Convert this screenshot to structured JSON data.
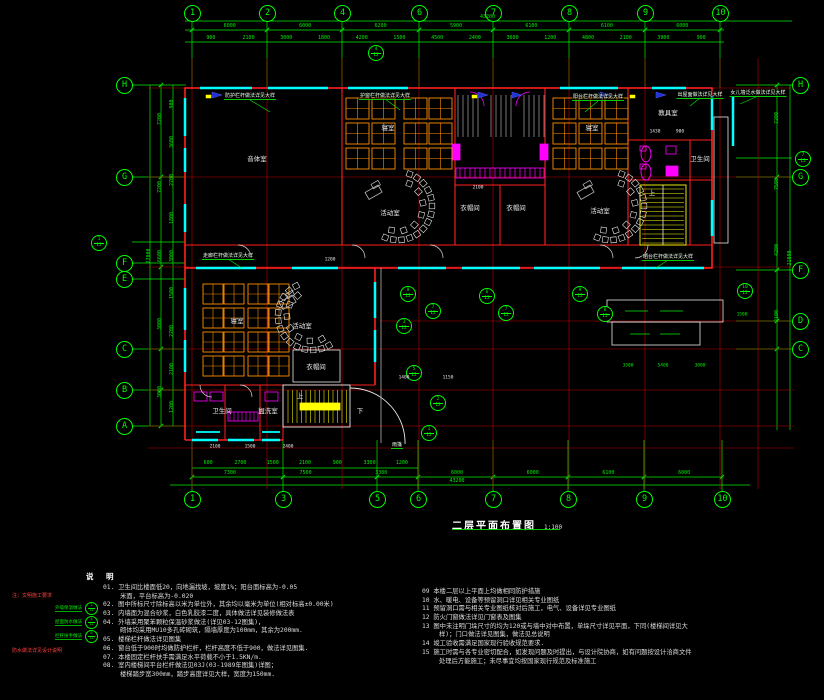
{
  "drawing": {
    "title": "二层平面布置图",
    "scale": "1:100",
    "colors": {
      "background": "#000000",
      "grid_green": "#00ee00",
      "wall_red": "#ff2020",
      "window_cyan": "#00ffff",
      "fixture_magenta": "#ff00ff",
      "stair_yellow": "#ffff00",
      "furniture_orange": "#ff8d00",
      "text_white": "#e8e8e8",
      "note_red": "#ff4040"
    },
    "grid": {
      "top": [
        {
          "label": "1",
          "x": 192
        },
        {
          "label": "2",
          "x": 267
        },
        {
          "label": "4",
          "x": 342
        },
        {
          "label": "6",
          "x": 419
        },
        {
          "label": "7",
          "x": 493
        },
        {
          "label": "8",
          "x": 569
        },
        {
          "label": "9",
          "x": 645
        },
        {
          "label": "10",
          "x": 720
        }
      ],
      "bottom": [
        {
          "label": "1",
          "x": 192
        },
        {
          "label": "3",
          "x": 283
        },
        {
          "label": "5",
          "x": 377
        },
        {
          "label": "6",
          "x": 418
        },
        {
          "label": "7",
          "x": 493
        },
        {
          "label": "8",
          "x": 568
        },
        {
          "label": "9",
          "x": 644
        },
        {
          "label": "10",
          "x": 722
        }
      ],
      "left": [
        {
          "label": "H",
          "y": 85
        },
        {
          "label": "G",
          "y": 177
        },
        {
          "label": "F",
          "y": 263
        },
        {
          "label": "E",
          "y": 279
        },
        {
          "label": "C",
          "y": 349
        },
        {
          "label": "B",
          "y": 390
        },
        {
          "label": "A",
          "y": 426
        }
      ],
      "right": [
        {
          "label": "H",
          "y": 85
        },
        {
          "label": "G",
          "y": 177
        },
        {
          "label": "F",
          "y": 270
        },
        {
          "label": "D",
          "y": 321
        },
        {
          "label": "C",
          "y": 349
        }
      ]
    },
    "rooms": [
      {
        "name": "音体室",
        "x": 257,
        "y": 158
      },
      {
        "name": "寝室",
        "x": 388,
        "y": 127
      },
      {
        "name": "寝室",
        "x": 592,
        "y": 127
      },
      {
        "name": "教具室",
        "x": 668,
        "y": 112
      },
      {
        "name": "卫生间",
        "x": 700,
        "y": 158
      },
      {
        "name": "活动室",
        "x": 390,
        "y": 212
      },
      {
        "name": "活动室",
        "x": 600,
        "y": 210
      },
      {
        "name": "衣帽间",
        "x": 470,
        "y": 207
      },
      {
        "name": "衣帽间",
        "x": 516,
        "y": 207
      },
      {
        "name": "上",
        "x": 652,
        "y": 192
      },
      {
        "name": "寝室",
        "x": 237,
        "y": 320
      },
      {
        "name": "活动室",
        "x": 302,
        "y": 325
      },
      {
        "name": "衣帽间",
        "x": 316,
        "y": 366
      },
      {
        "name": "卫生间",
        "x": 222,
        "y": 410
      },
      {
        "name": "盥洗室",
        "x": 268,
        "y": 410
      },
      {
        "name": "上",
        "x": 300,
        "y": 395
      },
      {
        "name": "下",
        "x": 360,
        "y": 410
      }
    ],
    "annotations": [
      {
        "text": "防护栏杆做法详见大样",
        "x": 250,
        "y": 92
      },
      {
        "text": "护窗栏杆做法详见大样",
        "x": 385,
        "y": 92
      },
      {
        "text": "阳台栏杆做法详见大样",
        "x": 598,
        "y": 93
      },
      {
        "text": "出屋面做法详见大样",
        "x": 700,
        "y": 91
      },
      {
        "text": "女儿墙泛水做法详见大样",
        "x": 758,
        "y": 89
      },
      {
        "text": "走廊栏杆做法详见大样",
        "x": 228,
        "y": 252
      },
      {
        "text": "晒台栏杆做法详见大样",
        "x": 668,
        "y": 253
      },
      {
        "text": "雨篷",
        "x": 397,
        "y": 441
      }
    ],
    "detail_markers": [
      {
        "x": 375,
        "y": 52,
        "num": "4",
        "den": "12"
      },
      {
        "x": 98,
        "y": 242,
        "num": "1",
        "den": "12"
      },
      {
        "x": 802,
        "y": 158,
        "num": "7",
        "den": "12"
      },
      {
        "x": 744,
        "y": 290,
        "num": "10",
        "den": "12"
      },
      {
        "x": 407,
        "y": 293,
        "num": "9",
        "den": "12"
      },
      {
        "x": 486,
        "y": 295,
        "num": "6",
        "den": "12"
      },
      {
        "x": 579,
        "y": 293,
        "num": "9",
        "den": "12"
      },
      {
        "x": 432,
        "y": 310,
        "num": "7",
        "den": "12"
      },
      {
        "x": 505,
        "y": 312,
        "num": "7",
        "den": "12"
      },
      {
        "x": 604,
        "y": 313,
        "num": "8",
        "den": "12"
      },
      {
        "x": 403,
        "y": 325,
        "num": "3",
        "den": "12"
      },
      {
        "x": 413,
        "y": 372,
        "num": "5",
        "den": "12"
      },
      {
        "x": 437,
        "y": 402,
        "num": "2",
        "den": "12"
      },
      {
        "x": 428,
        "y": 432,
        "num": "1",
        "den": "12"
      }
    ],
    "dims": [
      {
        "name": "top-total",
        "dir": "h",
        "x1": 185,
        "x2": 790,
        "y": 17,
        "values": [
          "43200"
        ]
      },
      {
        "name": "top-major",
        "dir": "h",
        "x1": 192,
        "x2": 720,
        "y": 26,
        "values": [
          "6000",
          "6000",
          "6200",
          "5900",
          "6100",
          "6100",
          "6000"
        ]
      },
      {
        "name": "top-minor",
        "dir": "h",
        "x1": 192,
        "x2": 720,
        "y": 38,
        "values": [
          "900",
          "2100",
          "3000",
          "1800",
          "4200",
          "1500",
          "4500",
          "2400",
          "3600",
          "1200",
          "4800",
          "2100",
          "3900",
          "900"
        ]
      },
      {
        "name": "bottom-minor",
        "dir": "h",
        "x1": 192,
        "x2": 418,
        "y": 463,
        "values": [
          "600",
          "2700",
          "1500",
          "2100",
          "900",
          "3300",
          "1200"
        ]
      },
      {
        "name": "bottom-major",
        "dir": "h",
        "x1": 192,
        "x2": 722,
        "y": 473,
        "values": [
          "7300",
          "7500",
          "3300",
          "6000",
          "6000",
          "6100",
          "6000"
        ]
      },
      {
        "name": "bottom-total",
        "dir": "h",
        "x1": 192,
        "x2": 722,
        "y": 481,
        "values": [
          "43200"
        ]
      },
      {
        "name": "left-minor",
        "dir": "v",
        "x": 172,
        "y1": 85,
        "y2": 426,
        "values": [
          "900",
          "3600",
          "2700",
          "1800",
          "3000",
          "1500",
          "2700",
          "2100",
          "1200"
        ]
      },
      {
        "name": "left-major",
        "dir": "v",
        "x": 160,
        "y1": 85,
        "y2": 426,
        "values": [
          "7200",
          "7200",
          "6600",
          "3000",
          "3000"
        ]
      },
      {
        "name": "left-total",
        "dir": "v",
        "x": 149,
        "y1": 85,
        "y2": 426,
        "values": [
          "27000"
        ]
      },
      {
        "name": "right-major",
        "dir": "v",
        "x": 777,
        "y1": 85,
        "y2": 349,
        "values": [
          "7200",
          "7500",
          "4200",
          "2100"
        ]
      },
      {
        "name": "right-total",
        "dir": "v",
        "x": 790,
        "y1": 85,
        "y2": 430,
        "values": [
          "21000"
        ]
      }
    ],
    "inner_dims": [
      {
        "t": "1400",
        "x": 404,
        "y": 378,
        "c": "w"
      },
      {
        "t": "1150",
        "x": 448,
        "y": 378,
        "c": "w"
      },
      {
        "t": "2100",
        "x": 478,
        "y": 188,
        "c": "w"
      },
      {
        "t": "1430",
        "x": 655,
        "y": 132,
        "c": "w"
      },
      {
        "t": "900",
        "x": 680,
        "y": 132,
        "c": "w"
      },
      {
        "t": "1200",
        "x": 330,
        "y": 260,
        "c": "w"
      },
      {
        "t": "2100",
        "x": 215,
        "y": 447,
        "c": "w"
      },
      {
        "t": "1500",
        "x": 250,
        "y": 447,
        "c": "w"
      },
      {
        "t": "2400",
        "x": 288,
        "y": 447,
        "c": "w"
      },
      {
        "t": "3300",
        "x": 628,
        "y": 366,
        "c": "g"
      },
      {
        "t": "5400",
        "x": 663,
        "y": 366,
        "c": "g"
      },
      {
        "t": "3000",
        "x": 700,
        "y": 366,
        "c": "g"
      },
      {
        "t": "1500",
        "x": 742,
        "y": 315,
        "c": "g"
      }
    ],
    "notes": {
      "header": "说 明",
      "left": [
        {
          "num": "01.",
          "lines": [
            "卫生间比楼面低20，向地漏找坡，坡度1%；阳台面标高为-0.05",
            "米面，平台标高为-0.020"
          ]
        },
        {
          "num": "02.",
          "lines": [
            "图中所标尺寸除标高以米为单位外，其余均以毫米为单位(相对标高±0.00米)"
          ]
        },
        {
          "num": "03.",
          "lines": [
            "内墙面为混合砂浆，白色乳胶漆二度，具体做法详见装修做法表"
          ]
        },
        {
          "num": "04.",
          "lines": [
            "外墙采用聚苯颗粒保温砂浆做法(详见03-12图集)，",
            "砌体均采用MU10多孔砖砌筑，隔墙厚度为100mm，其余为200mm."
          ]
        },
        {
          "num": "05.",
          "lines": [
            "楼梯栏杆做法详见图集"
          ]
        },
        {
          "num": "06.",
          "lines": [
            "窗台低于900时均做防护栏杆，栏杆高度不低于900，做法详见图集."
          ]
        },
        {
          "num": "07.",
          "lines": [
            "本楼固定栏杆扶手需满足水平荷载不小于1.5KN/m."
          ]
        },
        {
          "num": "08.",
          "lines": [
            "室内楼梯间平台栏杆做法见03J(03-1989年图集)详图；",
            "楼梯踏步宽300mm，踏步高度详见大样，宽度为150mm."
          ]
        }
      ],
      "right": [
        {
          "num": "09",
          "lines": [
            "本楼二层以上平面上均做相同防护措施"
          ]
        },
        {
          "num": "10",
          "lines": [
            "水、暖电、设备等预留洞口详见相关专业图纸"
          ]
        },
        {
          "num": "11",
          "lines": [
            "预留洞口需与相关专业图纸核对后施工，电气、设备详见专业图纸"
          ]
        },
        {
          "num": "12",
          "lines": [
            "防火门窗做法详见门窗表及图集"
          ]
        },
        {
          "num": "13",
          "lines": [
            "图中未注明门垛尺寸的均为120或与墙中对中布置，单垛尺寸详见平面，下同(楼梯间详见大",
            "样)；门口做法详见图集，做法见总说明"
          ]
        },
        {
          "num": "14",
          "lines": [
            "竣工验收需满足国家现行验收规范要求."
          ]
        },
        {
          "num": "15",
          "lines": [
            "施工时需与各专业密切配合，如发现问题及时提出，与设计院协商，如有问题按设计洽商文件",
            "处理后方能施工；未尽事宜均按国家现行规范及标准施工"
          ]
        }
      ]
    },
    "legend": {
      "title": "注：文明施工要求",
      "rows": [
        {
          "label": "外墙保温做法",
          "num": "2",
          "den": "12"
        },
        {
          "label": "屋面防水做法",
          "num": "4",
          "den": "12"
        },
        {
          "label": "栏杆扶手做法",
          "num": "6",
          "den": "12"
        }
      ],
      "footer": "防水做法详见设计说明"
    }
  }
}
